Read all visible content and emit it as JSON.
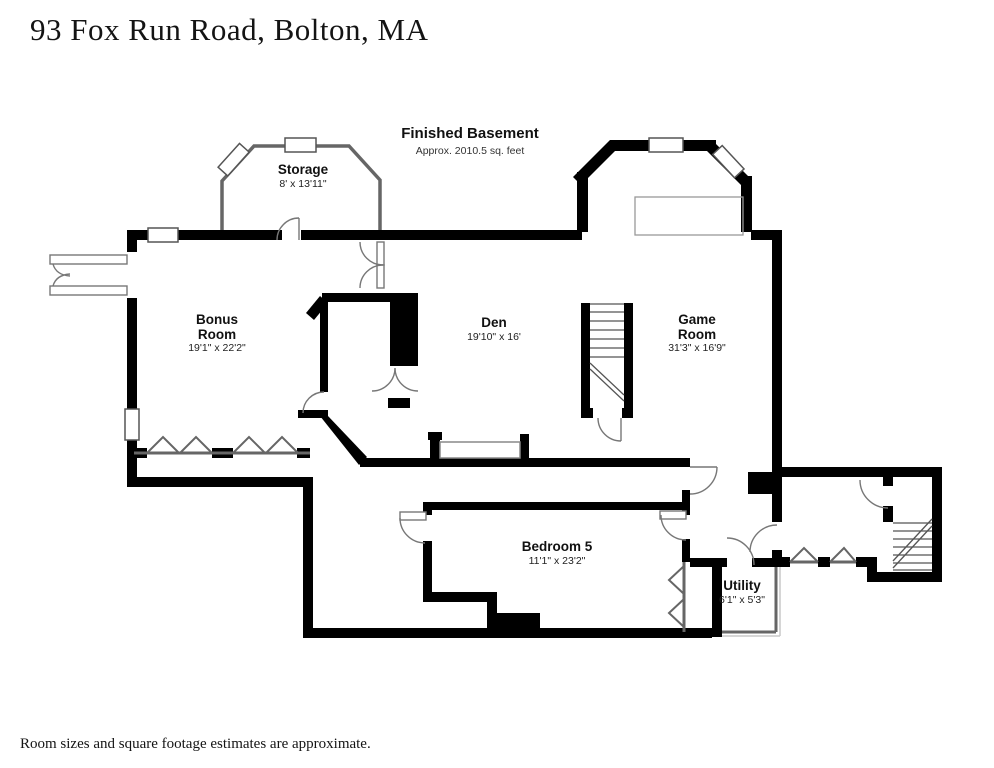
{
  "page": {
    "address_title": "93 Fox Run Road, Bolton, MA",
    "footer_note": "Room sizes and square footage estimates are approximate."
  },
  "plan": {
    "title": "Finished Basement",
    "area_note": "Approx. 2010.5 sq. feet"
  },
  "rooms": [
    {
      "id": "storage",
      "name": "Storage",
      "dimensions": "8' x 13'11\""
    },
    {
      "id": "bonus-room",
      "name": "Bonus Room",
      "dimensions": "19'1\" x 22'2\""
    },
    {
      "id": "den",
      "name": "Den",
      "dimensions": "19'10\" x 16'"
    },
    {
      "id": "game-room",
      "name": "Game Room",
      "dimensions": "31'3\" x 16'9\""
    },
    {
      "id": "bedroom-5",
      "name": "Bedroom 5",
      "dimensions": "11'1\" x 23'2\""
    },
    {
      "id": "utility",
      "name": "Utility",
      "dimensions": "6'1\" x 5'3\""
    }
  ],
  "colors": {
    "wall": "#000000",
    "thin_wall": "#666666",
    "door_arc": "#777777",
    "background": "#ffffff",
    "text": "#141414"
  }
}
